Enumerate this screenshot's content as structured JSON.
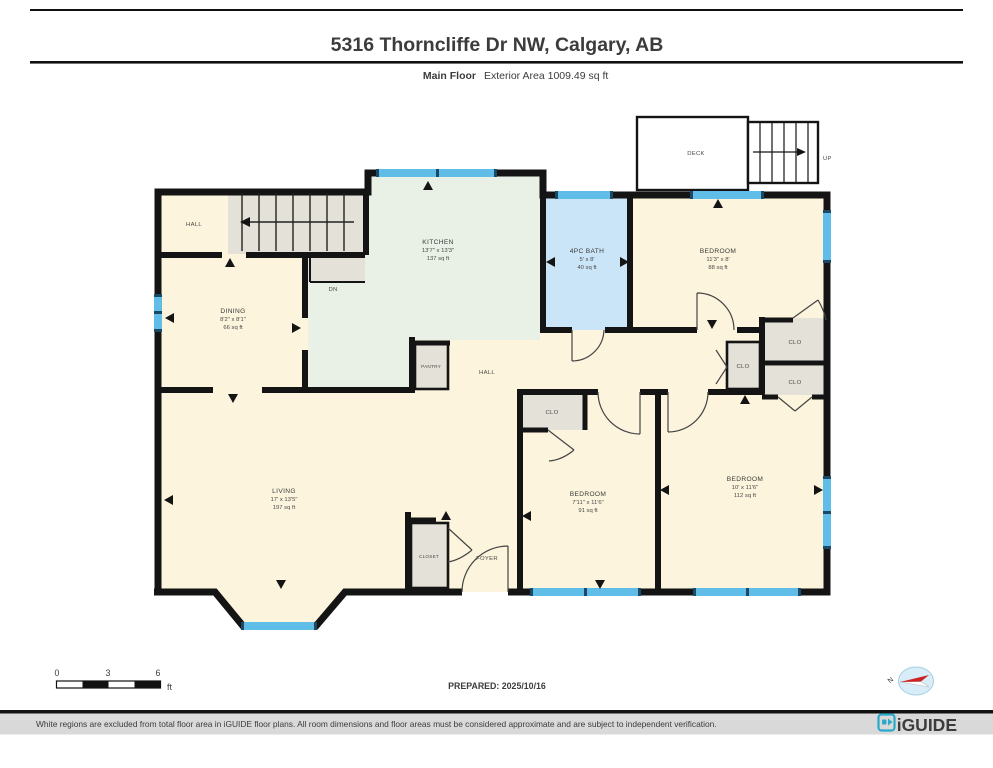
{
  "header": {
    "title": "5316 Thorncliffe Dr NW, Calgary, AB",
    "floor_label": "Main Floor",
    "area_label": "Exterior Area 1009.49 sq ft"
  },
  "plan": {
    "rooms": {
      "kitchen": {
        "name": "KITCHEN",
        "dims": "13'7\" x 13'3\"",
        "area": "137 sq ft"
      },
      "dining": {
        "name": "DINING",
        "dims": "8'2\" x 8'1\"",
        "area": "66 sq ft"
      },
      "living": {
        "name": "LIVING",
        "dims": "17' x 13'5\"",
        "area": "197 sq ft"
      },
      "bath": {
        "name": "4PC BATH",
        "dims": "5' x 8'",
        "area": "40 sq ft"
      },
      "bedroom_ne": {
        "name": "BEDROOM",
        "dims": "11'3\" x 8'",
        "area": "88 sq ft"
      },
      "bedroom_mid": {
        "name": "BEDROOM",
        "dims": "7'11\" x 11'6\"",
        "area": "91 sq ft"
      },
      "bedroom_se": {
        "name": "BEDROOM",
        "dims": "10' x 11'6\"",
        "area": "112 sq ft"
      }
    },
    "labels": {
      "hall_upper": "HALL",
      "hall_center": "HALL",
      "pantry": "PANTRY",
      "foyer": "FOYER",
      "closet": "CLOSET",
      "clo": "CLO",
      "dn": "DN",
      "deck": "DECK",
      "up": "UP"
    }
  },
  "scale_bar": {
    "tick_0": "0",
    "tick_3": "3",
    "tick_6": "6",
    "unit": "ft"
  },
  "prepared_label": "PREPARED: 2025/10/16",
  "compass": {
    "north_label": "N"
  },
  "footer": {
    "disclaimer": "White regions are excluded from total floor area in iGUIDE floor plans. All room dimensions and floor areas must be considered approximate and are subject to independent verification.",
    "brand": "iGUIDE"
  },
  "colors": {
    "wall": "#141414",
    "window": "#5FBDE8",
    "window_cap": "#1C4A66",
    "room_cream": "#FCF4DC",
    "kitchen_green": "#E9F0E5",
    "bath_blue": "#CBE5F8",
    "closet_gray": "#E4E1D8",
    "brand_teal": "#2BA9CB"
  }
}
